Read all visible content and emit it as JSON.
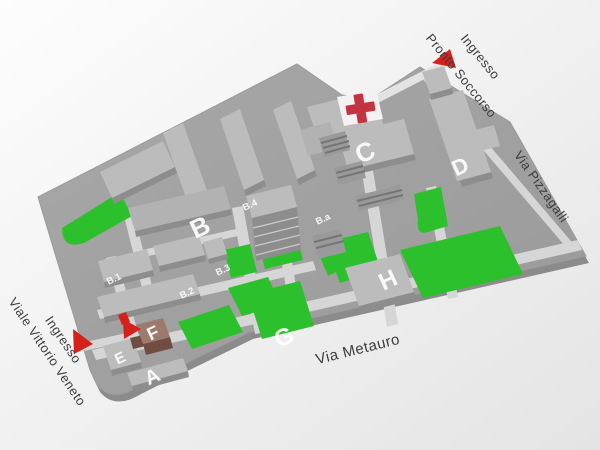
{
  "map": {
    "type": "hospital-campus-map",
    "highlighted_building": "F",
    "streets": {
      "metauro": "Via Metauro",
      "pizzagalli": "Via Pizzagalli"
    },
    "entrances": {
      "pronto_soccorso": {
        "line1": "Ingresso",
        "line2": "Pronto Soccorso"
      },
      "vittorio_veneto": {
        "line1": "Ingresso",
        "line2": "Viale Vittorio Veneto"
      }
    },
    "buildings": {
      "A": "A",
      "B": "B",
      "C": "C",
      "D": "D",
      "E": "E",
      "F": "F",
      "G": "G",
      "H": "H",
      "B1": "B.1",
      "B2": "B.2",
      "B3": "B.3",
      "B4": "B.4",
      "Ba": "B.a"
    },
    "icons": {
      "red_cross": "red-cross-icon",
      "entrance_arrow": "entrance-arrow-icon",
      "highlight_arrow": "location-arrow-icon"
    },
    "colors": {
      "lawn": "#2cc12c",
      "arrow_red": "#d6201c",
      "cross_red": "#c23440",
      "building_f_top": "#9c7b6d",
      "building_f_side": "#6f4d43",
      "campus_ground": "#a2a2a2",
      "road": "#d6d6d6",
      "street_text": "#3c3c3c"
    }
  }
}
